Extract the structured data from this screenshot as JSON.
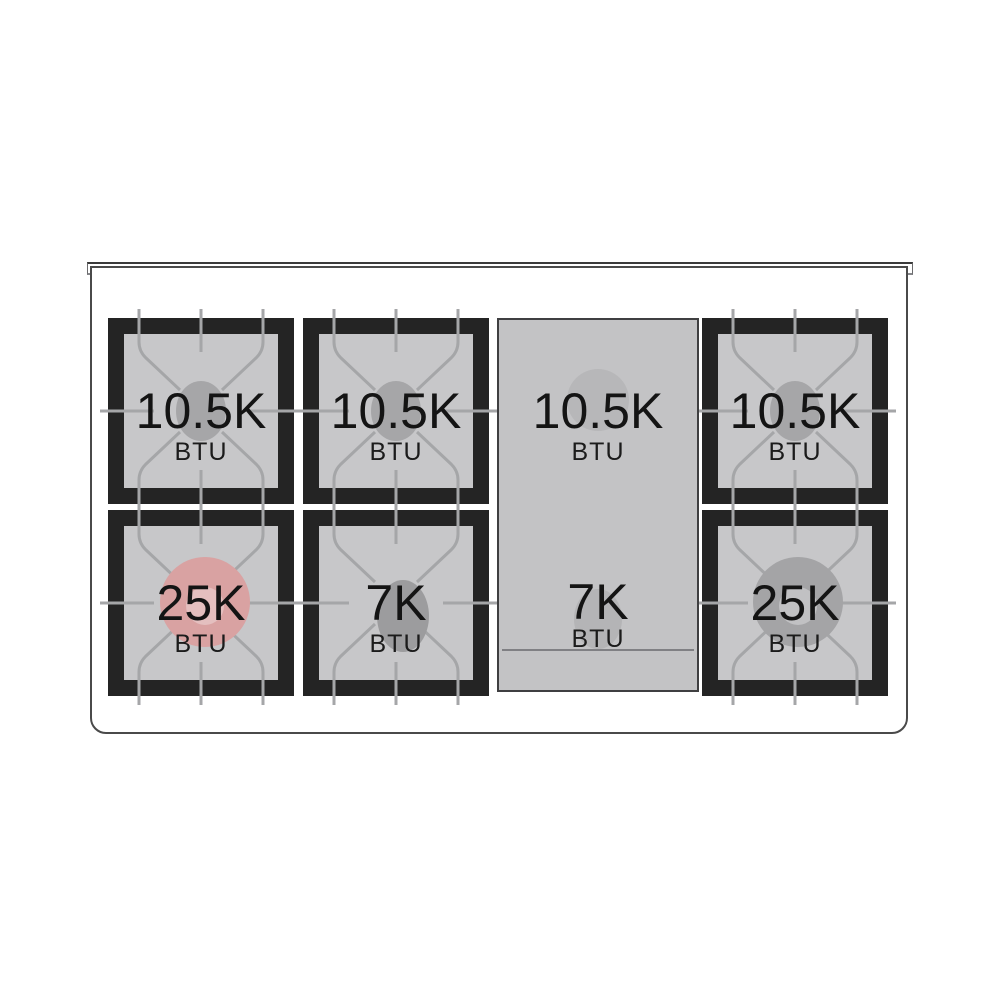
{
  "cooktop": {
    "burners": [
      {
        "id": "top-left",
        "power": "10.5K",
        "unit": "BTU"
      },
      {
        "id": "top-center",
        "power": "10.5K",
        "unit": "BTU"
      },
      {
        "id": "top-right",
        "power": "10.5K",
        "unit": "BTU"
      },
      {
        "id": "bottom-left",
        "power": "25K",
        "unit": "BTU"
      },
      {
        "id": "bottom-center",
        "power": "7K",
        "unit": "BTU"
      },
      {
        "id": "bottom-right",
        "power": "25K",
        "unit": "BTU"
      }
    ],
    "griddle": {
      "top_power": "10.5K",
      "top_unit": "BTU",
      "bottom_power": "7K",
      "bottom_unit": "BTU"
    },
    "colors": {
      "burner_frame": "#242424",
      "burner_surface": "#c7c7c9",
      "grate_line": "#a5a6a8",
      "burner_cap_gray": "#a6a6a8",
      "burner_cap_pink": "#d9a2a2",
      "burner_cap_pink_inner": "#e4bfbf",
      "burner_cap_dark_gray": "#a4a4a6",
      "burner_cap_dark_gray_inner": "#c1c1c3",
      "griddle_surface": "#c3c3c5",
      "label_text": "#141414"
    }
  }
}
